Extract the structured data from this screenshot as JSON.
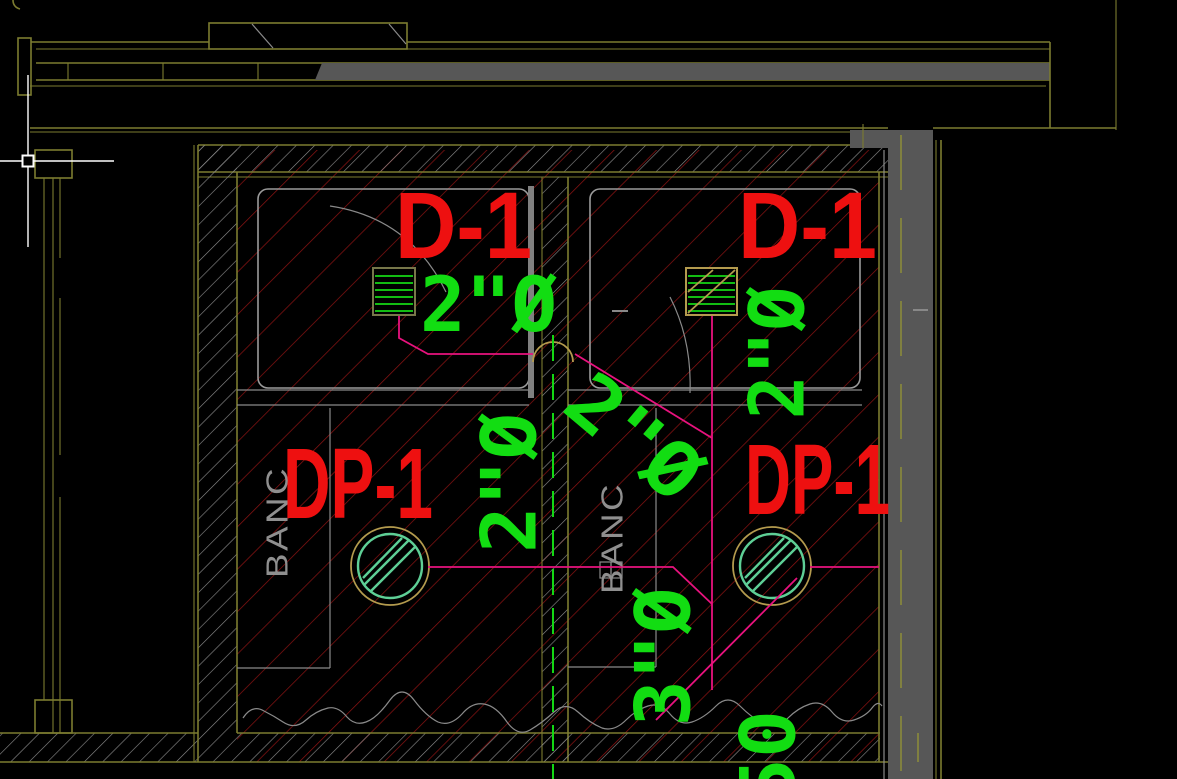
{
  "drawing": {
    "labels": {
      "shower_drain_left": "D-1",
      "shower_drain_right": "D-1",
      "floor_drain_left": "DP-1",
      "floor_drain_right": "DP-1",
      "pipe_size_shower_left": "2\"Ø",
      "pipe_size_left_riser": "2\"Ø",
      "pipe_size_right_riser": "2\"Ø",
      "pipe_size_branch": "2\"Ø",
      "pipe_size_main": "3\"Ø",
      "pipe_size_bottom": "50",
      "bench_left": "BANC",
      "bench_center": "BANC"
    },
    "colors": {
      "background": "#000000",
      "wall_outline_olive": "#7c7c30",
      "wall_fill_gray": "#575757",
      "hatch_red": "#8e1313",
      "hatch_gray": "#8f8f8f",
      "pipe_magenta": "#e8127e",
      "annotation_green": "#12dd12",
      "label_red": "#ee1010",
      "bench_text_gray": "#8f8f8f",
      "drain_trim_tan": "#b49b4e",
      "drain_inner_green": "#5ecf96",
      "centerline_green": "#14d714",
      "cursor_white": "#ffffff"
    },
    "cursor": {
      "x": 28,
      "y": 161
    }
  }
}
